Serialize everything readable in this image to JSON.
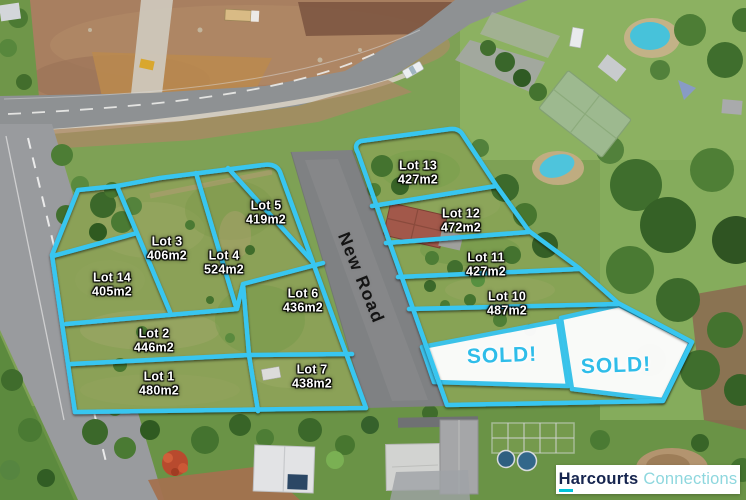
{
  "road": {
    "label": "New Road"
  },
  "lots": [
    {
      "name": "Lot 1",
      "area": "480m2"
    },
    {
      "name": "Lot 2",
      "area": "446m2"
    },
    {
      "name": "Lot 3",
      "area": "406m2"
    },
    {
      "name": "Lot 4",
      "area": "524m2"
    },
    {
      "name": "Lot 5",
      "area": "419m2"
    },
    {
      "name": "Lot 6",
      "area": "436m2"
    },
    {
      "name": "Lot 7",
      "area": "438m2"
    },
    {
      "name": "Lot 10",
      "area": "487m2"
    },
    {
      "name": "Lot 11",
      "area": "427m2"
    },
    {
      "name": "Lot 12",
      "area": "472m2"
    },
    {
      "name": "Lot 13",
      "area": "427m2"
    },
    {
      "name": "Lot 14",
      "area": "405m2"
    }
  ],
  "sold_lots": [
    {
      "label": "SOLD!"
    },
    {
      "label": "SOLD!"
    }
  ],
  "branding": {
    "agency": "Harcourts",
    "suffix": "Connections"
  },
  "colors": {
    "boundary": "#38c6f0",
    "sold_text": "#2fbde9",
    "brand_navy": "#16254f",
    "brand_teal": "#8ed7de",
    "brand_underline": "#00c3d8"
  }
}
